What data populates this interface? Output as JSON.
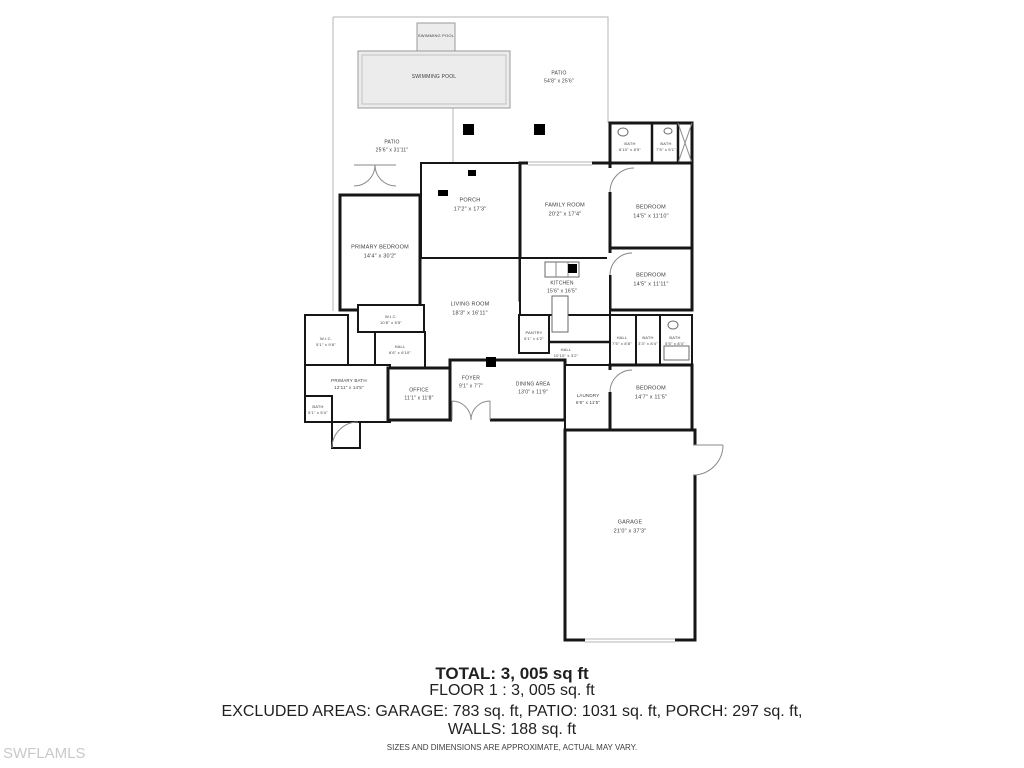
{
  "watermark": "SWFLAMLS",
  "footer": {
    "total": "TOTAL:  3, 005 sq ft",
    "floor": "FLOOR 1 : 3, 005  sq. ft",
    "excluded_line1": "EXCLUDED AREAS: GARAGE: 783 sq. ft, PATIO: 1031 sq. ft, PORCH: 297 sq. ft,",
    "excluded_line2": "WALLS: 188 sq. ft",
    "disclaimer": "SIZES AND DIMENSIONS ARE APPROXIMATE, ACTUAL MAY VARY."
  },
  "colors": {
    "wall": "#161616",
    "patio_line": "#b5b5b5",
    "pool_fill": "#ececec",
    "label_text": "#3c3c3c",
    "watermark": "#c9c9c9"
  },
  "plan": {
    "rooms": [
      {
        "label": "SWIMMING POOL",
        "dims": "",
        "x": 436,
        "y": 36,
        "size": 4
      },
      {
        "label": "SWIMMING POOL",
        "dims": "",
        "x": 434,
        "y": 78,
        "size": 5
      },
      {
        "label": "PATIO",
        "dims": "54'8\" x 25'6\"",
        "x": 559,
        "y": 78,
        "size": 5
      },
      {
        "label": "PATIO",
        "dims": "25'6\" x 31'11\"",
        "x": 392,
        "y": 147,
        "size": 5
      },
      {
        "label": "PORCH",
        "dims": "17'2\" x 17'3\"",
        "x": 470,
        "y": 205,
        "size": 5.5
      },
      {
        "label": "FAMILY ROOM",
        "dims": "20'2\" x 17'4\"",
        "x": 565,
        "y": 210,
        "size": 5.5
      },
      {
        "label": "BATH",
        "dims": "6'10\" x 8'5\"",
        "x": 630,
        "y": 147,
        "size": 4
      },
      {
        "label": "BATH",
        "dims": "7'5\" x 5'1\"",
        "x": 666,
        "y": 147,
        "size": 4
      },
      {
        "label": "BEDROOM",
        "dims": "14'5\" x 11'10\"",
        "x": 651,
        "y": 212,
        "size": 5.5
      },
      {
        "label": "BEDROOM",
        "dims": "14'5\" x 11'11\"",
        "x": 651,
        "y": 280,
        "size": 5.5
      },
      {
        "label": "PRIMARY BEDROOM",
        "dims": "14'4\" x 30'2\"",
        "x": 380,
        "y": 252,
        "size": 5.5
      },
      {
        "label": "LIVING ROOM",
        "dims": "18'3\" x 16'11\"",
        "x": 470,
        "y": 309,
        "size": 5.5
      },
      {
        "label": "KITCHEN",
        "dims": "15'6\" x 16'5\"",
        "x": 562,
        "y": 288,
        "size": 5
      },
      {
        "label": "W.I.C.",
        "dims": "10'8\" x 5'5\"",
        "x": 391,
        "y": 320,
        "size": 4
      },
      {
        "label": "W.I.C.",
        "dims": "5'1\" x 9'8\"",
        "x": 326,
        "y": 342,
        "size": 4
      },
      {
        "label": "HALL",
        "dims": "6'6\" x 6'10\"",
        "x": 400,
        "y": 350,
        "size": 4
      },
      {
        "label": "PANTRY",
        "dims": "5'1\" x 4'2\"",
        "x": 534,
        "y": 336,
        "size": 4
      },
      {
        "label": "HALL",
        "dims": "10'10\" x 3'2\"",
        "x": 566,
        "y": 353,
        "size": 4
      },
      {
        "label": "PRIMARY BATH",
        "dims": "12'11\" x 14'5\"",
        "x": 349,
        "y": 385,
        "size": 4.5
      },
      {
        "label": "BATH",
        "dims": "5'1\" x 5'4\"",
        "x": 318,
        "y": 410,
        "size": 4
      },
      {
        "label": "OFFICE",
        "dims": "11'1\" x 11'8\"",
        "x": 419,
        "y": 395,
        "size": 5
      },
      {
        "label": "FOYER",
        "dims": "9'1\" x 7'7\"",
        "x": 471,
        "y": 383,
        "size": 5
      },
      {
        "label": "DINING AREA",
        "dims": "13'0\" x 11'9\"",
        "x": 533,
        "y": 389,
        "size": 5
      },
      {
        "label": "LAUNDRY",
        "dims": "6'6\" x 11'5\"",
        "x": 588,
        "y": 400,
        "size": 4.5
      },
      {
        "label": "HALL",
        "dims": "7'5\" x 8'8\"",
        "x": 622,
        "y": 341,
        "size": 4
      },
      {
        "label": "BATH",
        "dims": "3'3\" x 8'4\"",
        "x": 648,
        "y": 341,
        "size": 4
      },
      {
        "label": "BATH",
        "dims": "5'5\" x 8'4\"",
        "x": 675,
        "y": 341,
        "size": 4
      },
      {
        "label": "BEDROOM",
        "dims": "14'7\" x 11'5\"",
        "x": 651,
        "y": 393,
        "size": 5.5
      },
      {
        "label": "GARAGE",
        "dims": "21'0\" x 37'3\"",
        "x": 630,
        "y": 527,
        "size": 5.5
      }
    ]
  }
}
